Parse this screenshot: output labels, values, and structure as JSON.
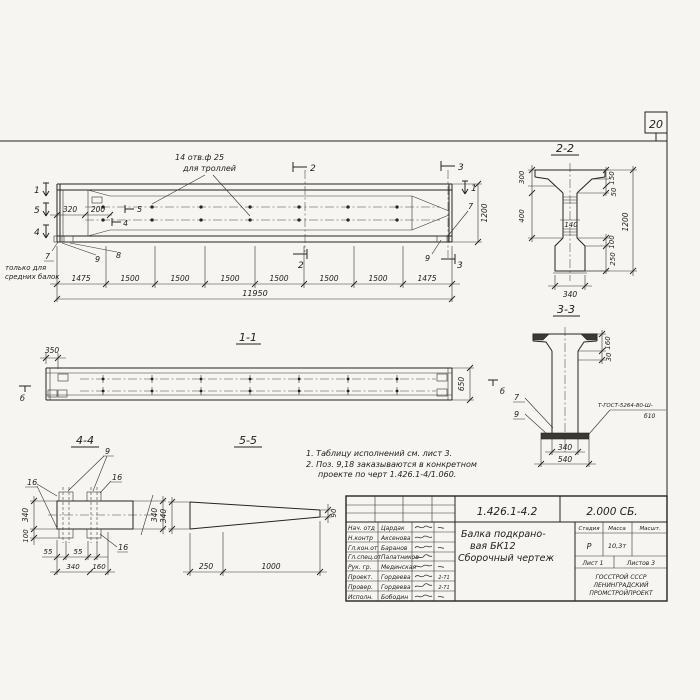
{
  "sheet": {
    "page_number": "20"
  },
  "elevation": {
    "hole_note": [
      "14 отв.ф 25",
      "для троллей"
    ],
    "side_note": [
      "только для",
      "средних балок"
    ],
    "markers": {
      "sec1": "1",
      "sec2": "2",
      "sec3": "3",
      "sec4": "4",
      "sec5": "5"
    },
    "pos": {
      "p7": "7",
      "p8": "8",
      "p9": "9"
    },
    "dims": {
      "d320": "320",
      "d200": "200",
      "d1200": "1200",
      "segments": [
        "1475",
        "1500",
        "1500",
        "1500",
        "1500",
        "1500",
        "1500",
        "1475"
      ],
      "total": "11950"
    }
  },
  "section11": {
    "title": "1-1",
    "d350": "350",
    "d650": "650",
    "marker_b": "б"
  },
  "section22": {
    "title": "2-2",
    "d300": "300",
    "d400": "400",
    "d140": "140",
    "d150": "150",
    "d50": "50",
    "d1200": "1200",
    "d100": "100",
    "d250": "250",
    "d340": "340"
  },
  "section33": {
    "title": "3-3",
    "d160": "160",
    "d30": "30",
    "p7": "7",
    "p9": "9",
    "weld_note_1": "Т-ГОСТ-5264-80-Ш-",
    "weld_note_2": "б10",
    "d340": "340",
    "d540": "540"
  },
  "section44": {
    "title": "4-4",
    "p9": "9",
    "p16": "16",
    "d340_left": "340",
    "d100": "100",
    "d340_right": "340",
    "d55_a": "55",
    "d55_b": "55",
    "d340_bottom": "340",
    "d160": "160"
  },
  "section55": {
    "title": "5-5",
    "d340": "340",
    "d90": "90",
    "d250": "250",
    "d1000": "1000"
  },
  "notes": [
    "1. Таблицу исполнений см. лист 3.",
    "2. Поз. 9,18 заказываются в конкретном",
    "проекте по черт 1.426.1-4/1.060."
  ],
  "titleblock": {
    "doc_number": "1.426.1-4.2",
    "doc_code": "2.000 СБ.",
    "title_lines": [
      "Балка подкрано-",
      "вая БК12",
      "Сборочный чертеж"
    ],
    "stage_header": [
      "Стадия",
      "Масса",
      "Масшт."
    ],
    "stage_value": "Р",
    "mass_value": "10,3т",
    "sheet_no": "Лист 1",
    "sheets_total": "Листов 3",
    "org_lines": [
      "ГОССТРОЙ СССР",
      "ЛЕНИНГРАДСКИЙ",
      "ПРОМСТРОЙПРОЕКТ"
    ],
    "staff": [
      {
        "role": "Нач. отд",
        "name": "Цардак",
        "date": ""
      },
      {
        "role": "Н.контр",
        "name": "Аксенова",
        "date": ""
      },
      {
        "role": "Гл.кон.от",
        "name": "Баранов",
        "date": ""
      },
      {
        "role": "Гл.спец.от",
        "name": "Палатников",
        "date": ""
      },
      {
        "role": "Рук. гр.",
        "name": "Мединская",
        "date": ""
      },
      {
        "role": "Проект.",
        "name": "Гордеева",
        "date": "2-71"
      },
      {
        "role": "Провер.",
        "name": "Гордеева",
        "date": "2-71"
      },
      {
        "role": "Исполн.",
        "name": "Бободин",
        "date": ""
      }
    ]
  }
}
